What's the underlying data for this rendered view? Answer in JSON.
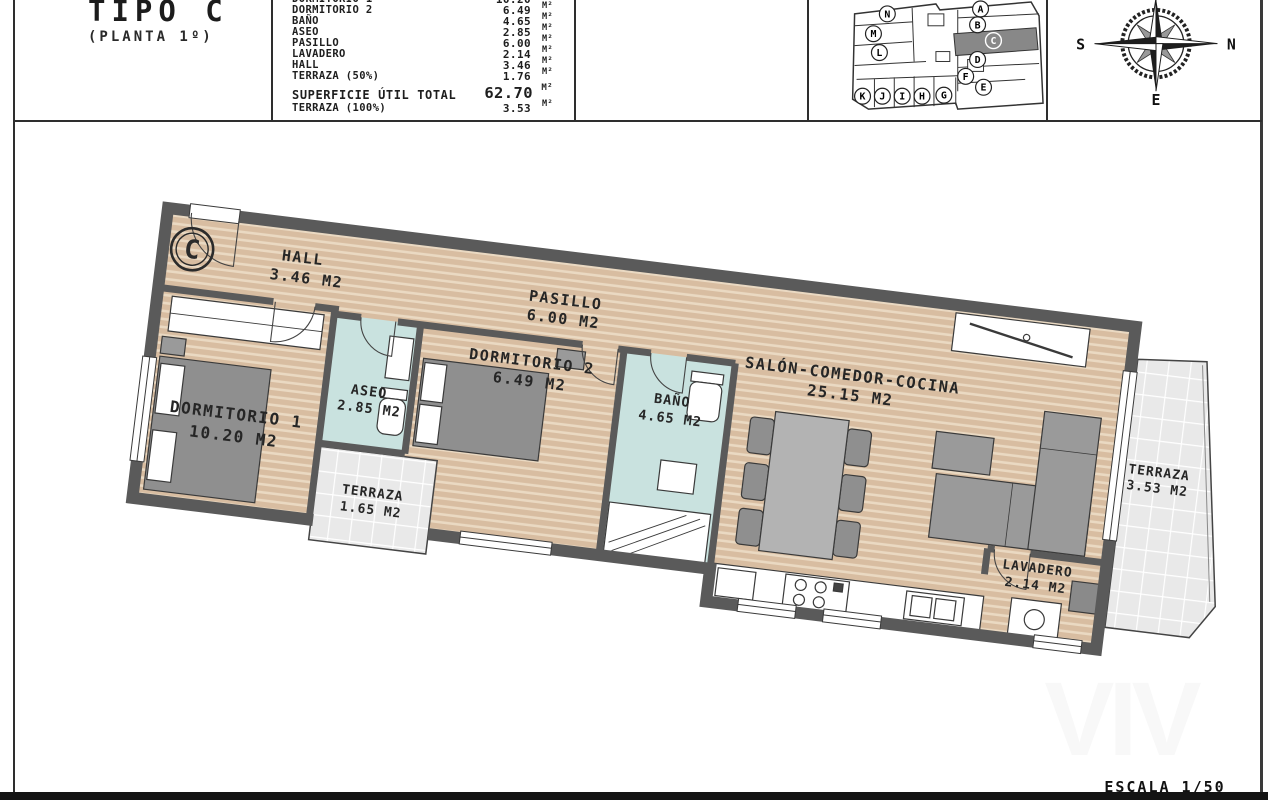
{
  "header": {
    "title": "TIPO C",
    "subtitle": "(PLANTA 1º)",
    "areas": {
      "rows": [
        {
          "label": "DORMITORIO 1",
          "value": "10.20",
          "unit": "M²"
        },
        {
          "label": "DORMITORIO 2",
          "value": "6.49",
          "unit": "M²"
        },
        {
          "label": "BAÑO",
          "value": "4.65",
          "unit": "M²"
        },
        {
          "label": "ASEO",
          "value": "2.85",
          "unit": "M²"
        },
        {
          "label": "PASILLO",
          "value": "6.00",
          "unit": "M²"
        },
        {
          "label": "LAVADERO",
          "value": "2.14",
          "unit": "M²"
        },
        {
          "label": "HALL",
          "value": "3.46",
          "unit": "M²"
        },
        {
          "label": "TERRAZA (50%)",
          "value": "1.76",
          "unit": "M²"
        }
      ],
      "totals": [
        {
          "label": "SUPERFICIE ÚTIL TOTAL",
          "value": "62.70",
          "unit": "M²"
        },
        {
          "label": "TERRAZA (100%)",
          "value": "3.53",
          "unit": "M²"
        }
      ]
    },
    "siteplan": {
      "units": [
        "A",
        "B",
        "C",
        "D",
        "E",
        "F",
        "G",
        "H",
        "I",
        "J",
        "K",
        "L",
        "M",
        "N"
      ],
      "highlighted": "C"
    },
    "compass": {
      "left": "S",
      "right": "N",
      "bottom": "E"
    }
  },
  "plan": {
    "badge": "C",
    "rooms": [
      {
        "name": "HALL",
        "area": "3.46 M2"
      },
      {
        "name": "PASILLO",
        "area": "6.00 M2"
      },
      {
        "name": "DORMITORIO 1",
        "area": "10.20 M2"
      },
      {
        "name": "ASEO",
        "area": "2.85 M2"
      },
      {
        "name": "DORMITORIO 2",
        "area": "6.49 M2"
      },
      {
        "name": "BAÑO",
        "area": "4.65 M2"
      },
      {
        "name": "TERRAZA",
        "area": "1.65 M2"
      },
      {
        "name": "SALÓN-COMEDOR-COCINA",
        "area": "25.15 M2"
      },
      {
        "name": "TERRAZA",
        "area": "3.53 M2"
      },
      {
        "name": "LAVADERO",
        "area": "2.14 M2"
      }
    ]
  },
  "footer": {
    "scale": "ESCALA 1/50",
    "watermark": "VIV"
  },
  "colors": {
    "wall": "#5a5a5a",
    "wood_floor": "#d8bda1",
    "wet_floor": "#c9e2df",
    "terrace_tile": "#ebebeb",
    "furniture": "#9a9a9a",
    "highlight_unit": "#888888"
  }
}
